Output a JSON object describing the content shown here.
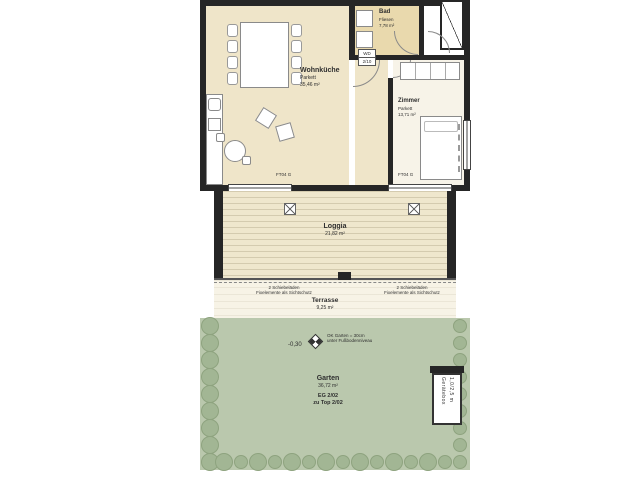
{
  "rooms": {
    "wohnkueche": {
      "name": "Wohnküche",
      "floor": "Parkett",
      "area": "35,46 m²"
    },
    "bad": {
      "name": "Bad",
      "floor": "Fliesen",
      "area": "7,78 m²"
    },
    "zimmer": {
      "name": "Zimmer",
      "floor": "Parkett",
      "area": "13,71 m²"
    },
    "loggia": {
      "name": "Loggia",
      "area": "21,82 m²"
    },
    "terrasse": {
      "name": "Terrasse",
      "area": "9,25 m²"
    },
    "garten": {
      "name": "Garten",
      "area": "36,72 m²",
      "unit": "EG 2/02",
      "assignment": "zu Top 2/02"
    }
  },
  "annotations": {
    "level_value": "-0,30",
    "level_note1": "OK Garten = 30cm",
    "level_note2": "unter Fußbodenniveau",
    "shutter_line1": "2 Schiebeläden",
    "shutter_line2": "Fixelemente als Sichtschutz",
    "window_label_left": "FT04 G",
    "window_label_right": "FT04 G",
    "door_label_top": "WD",
    "door_label_bottom": "2/10",
    "shed_line1": "Gerätebox",
    "shed_line2": "1,0/2,5 m"
  },
  "colors": {
    "wall": "#262626",
    "floor_beige": "#efe5c9",
    "bad_tan": "#e9d9ad",
    "zimmer_floor": "#f7f3e8",
    "loggia_floor": "#efe7cd",
    "terrace_floor": "#f7f3e6",
    "garden_green": "#bac8ad",
    "bush_green": "#a2b694",
    "bush_edge": "#8ea37f"
  }
}
